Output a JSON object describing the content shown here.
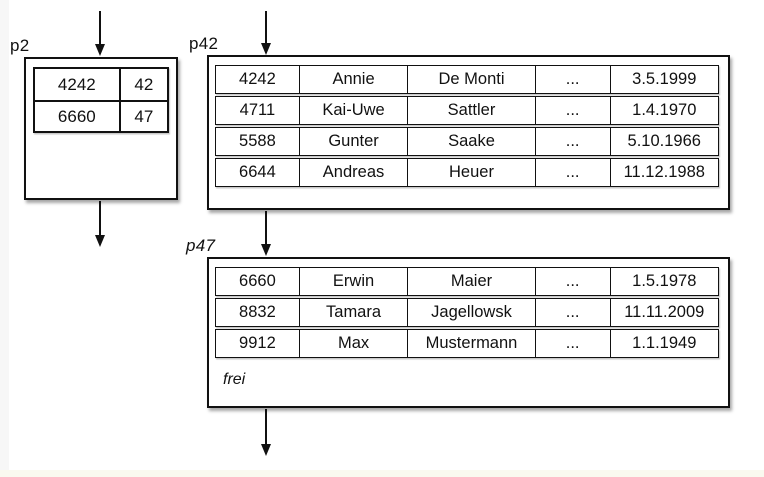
{
  "diagram": {
    "pages": {
      "p2": {
        "label": "p2",
        "rows": [
          [
            "4242",
            "42"
          ],
          [
            "6660",
            "47"
          ]
        ]
      },
      "p42": {
        "label": "p42",
        "rows": [
          [
            "4242",
            "Annie",
            "De Monti",
            "...",
            "3.5.1999"
          ],
          [
            "4711",
            "Kai-Uwe",
            "Sattler",
            "...",
            "1.4.1970"
          ],
          [
            "5588",
            "Gunter",
            "Saake",
            "...",
            "5.10.1966"
          ],
          [
            "6644",
            "Andreas",
            "Heuer",
            "...",
            "11.12.1988"
          ]
        ]
      },
      "p47": {
        "label": "p47",
        "rows": [
          [
            "6660",
            "Erwin",
            "Maier",
            "...",
            "1.5.1978"
          ],
          [
            "8832",
            "Tamara",
            "Jagellowsk",
            "...",
            "11.11.2009"
          ],
          [
            "9912",
            "Max",
            "Mustermann",
            "...",
            "1.1.1949"
          ]
        ],
        "free_label": "frei"
      }
    },
    "colors": {
      "line": "#111111",
      "background": "#ffffff",
      "shadow": "rgba(0,0,0,0.35)"
    }
  }
}
